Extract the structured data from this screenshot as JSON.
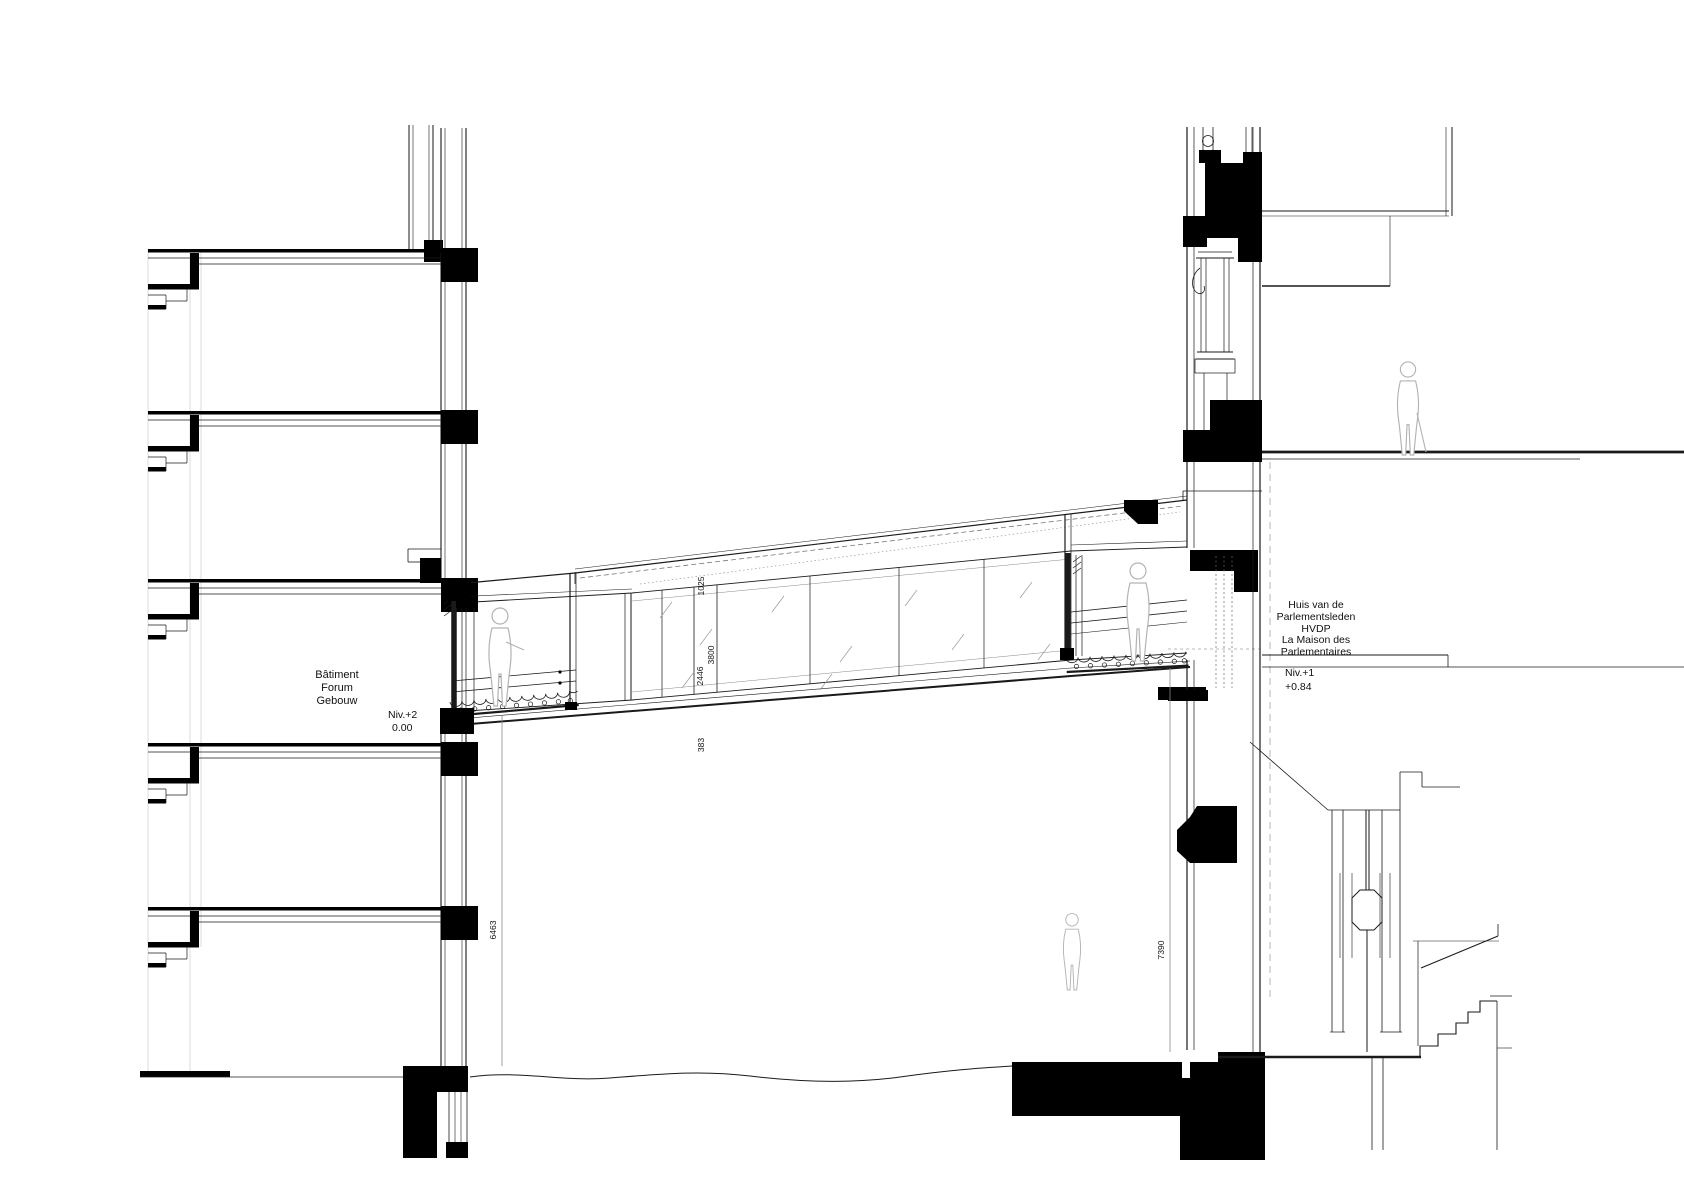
{
  "drawing_type": "architectural-section-footbridge",
  "left_building": {
    "name": [
      "Bâtiment",
      "Forum",
      "Gebouw"
    ],
    "level": "Niv.+2",
    "elevation": "0.00",
    "height_dimension": "6463"
  },
  "right_building": {
    "name": [
      "Huis van de",
      "Parlementsleden",
      "HVDP",
      "La Maison des",
      "Parlementaires"
    ],
    "level": "Niv.+1",
    "elevation": "+0.84",
    "height_dimension": "7390"
  },
  "bridge": {
    "dimensions": {
      "roof_band": "1025",
      "overall_height": "3800",
      "glazing_height": "2446",
      "floor_depth": "383"
    }
  },
  "colors": {
    "ink": "#1a1a1a",
    "solid_fill": "#000000",
    "light_gray": "#b3b3b3",
    "paper": "#ffffff"
  }
}
